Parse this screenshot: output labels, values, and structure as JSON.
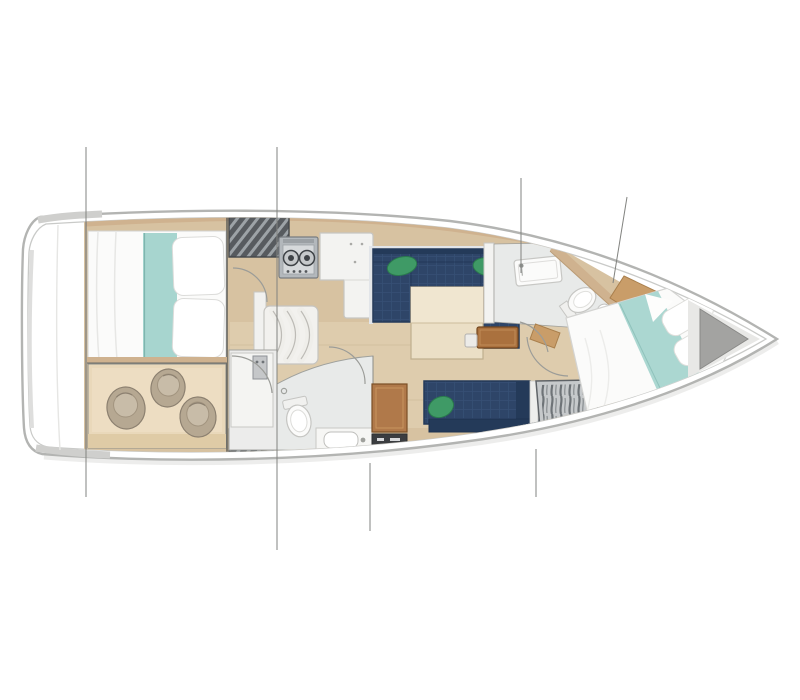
{
  "figure": {
    "kind": "sailboat-interior-floor-plan",
    "view": "top-down",
    "orientation": "bow-right",
    "background": "#ffffff",
    "text_labels": []
  },
  "palette": {
    "hull_outline": "#b3b4b2",
    "hull_inner_line": "#c9cac8",
    "stern_shade": "#cfcfcd",
    "deck_trim_wood": "#cfb28f",
    "floor_wood": "#d7c2a1",
    "floor_wood_light": "#e2d1b3",
    "storage_floor": "#e9d8ba",
    "bed_white": "#fbfbfa",
    "pillow_white": "#ffffff",
    "blanket_teal": "#a7d5cf",
    "settee_navy": "#2e4568",
    "settee_navy_dark": "#243a59",
    "cushion_green": "#3f9a66",
    "cushion_green_line": "#2a7a4d",
    "table_wood": "#ebdfc6",
    "table_wood_top": "#f0e6d0",
    "leaf_brown": "#aa713e",
    "desk_brown": "#b0794a",
    "instrument_black": "#3b3d40",
    "bath_floor": "#e8eae9",
    "fixture_white": "#f6f6f4",
    "fixture_line": "#c6c6c3",
    "hatch_dark": "#575b5f",
    "hatch_stripe": "#9da3a7",
    "wardrobe_base": "#c6c9cb",
    "wardrobe_stripe": "#6e7377",
    "fender_body": "#b6a892",
    "fender_line": "#8c8070",
    "stove_body": "#b3b8bc",
    "burner_dark": "#3f4347",
    "counter_white": "#f3f3f1",
    "wall_line": "#8b8c88",
    "bulkhead_line": "#4f504e",
    "door_arc": "#9b9c98",
    "rig_line": "#828380",
    "bow_locker_grey": "#a3a3a1"
  },
  "rooms": [
    {
      "id": "stern-deck",
      "label": "stern deck and transom"
    },
    {
      "id": "aft-cabin",
      "label": "aft double cabin with teal blanket runner"
    },
    {
      "id": "aft-storage",
      "label": "aft storage room with three fenders"
    },
    {
      "id": "companionway",
      "label": "companionway hatch and steps"
    },
    {
      "id": "galley",
      "label": "galley with two-burner stove and L-shaped counter"
    },
    {
      "id": "salon",
      "label": "salon with U-shaped navy settee and table"
    },
    {
      "id": "aft-head",
      "label": "aft head with toilet and sink"
    },
    {
      "id": "starboard-settee",
      "label": "starboard straight settee"
    },
    {
      "id": "nav-desk",
      "label": "chart desk with instrument strip"
    },
    {
      "id": "forward-head",
      "label": "forward head with shower tray and toilet"
    },
    {
      "id": "wardrobe",
      "label": "hanging wardrobe with clothes"
    },
    {
      "id": "forward-cabin",
      "label": "forward V-berth cabin with teal blanket runner"
    },
    {
      "id": "bow-locker",
      "label": "bow anchor locker"
    }
  ],
  "counts": {
    "stove_burners": 2,
    "fenders": 3,
    "salon_green_cushions": 3,
    "settee_green_cushions": 1,
    "double_berths": 3,
    "rigging_reference_lines": 6
  }
}
